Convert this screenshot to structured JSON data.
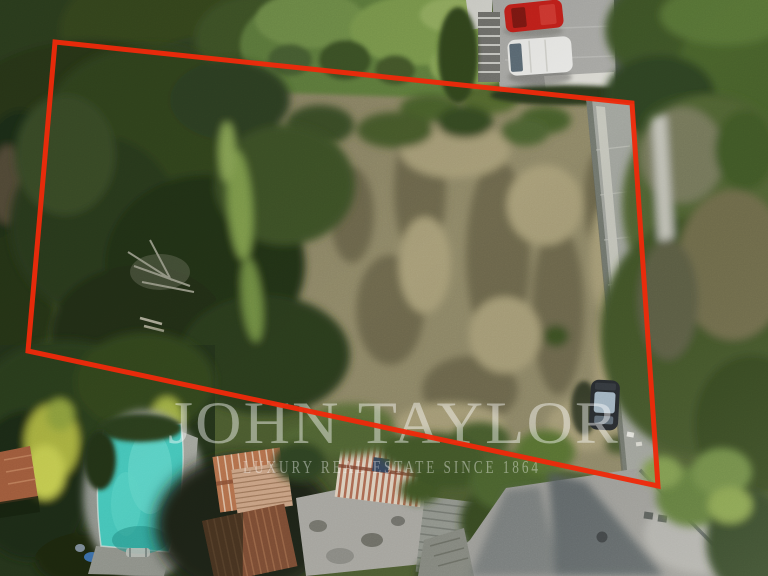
{
  "image": {
    "kind": "aerial-drone-photo",
    "subject": "building plot for sale outlined in red",
    "width": 768,
    "height": 576
  },
  "watermark": {
    "brand": "JOHN TAYLOR",
    "tagline": "LUXURY REAL ESTATE SINCE 1864"
  },
  "boundary": {
    "points": "55,42 632,103 658,486 28,351",
    "color": "#ee2a0a",
    "stroke_width": 5
  },
  "colors": {
    "boundary-red": "#ee2a0a",
    "field-tan": "#8d8666",
    "canopy-dark": "#2b3b1b",
    "canopy-mid": "#465a2c",
    "grass-bright": "#7f9c4c",
    "road-grey": "#9d9d99",
    "pool-turquoise": "#45c4b8",
    "roof-terracotta": "#b4714c",
    "car-red": "#c2201a",
    "van-white": "#e9e9e6",
    "car-black": "#23272c",
    "watermark-white": "#ffffff"
  },
  "scene_objects": [
    "overgrown dry field plot",
    "red boundary polygon overlay",
    "swimming pool",
    "terracotta roof houses",
    "driveway with red car and white van",
    "black car on lane",
    "access road with tree shadows"
  ]
}
